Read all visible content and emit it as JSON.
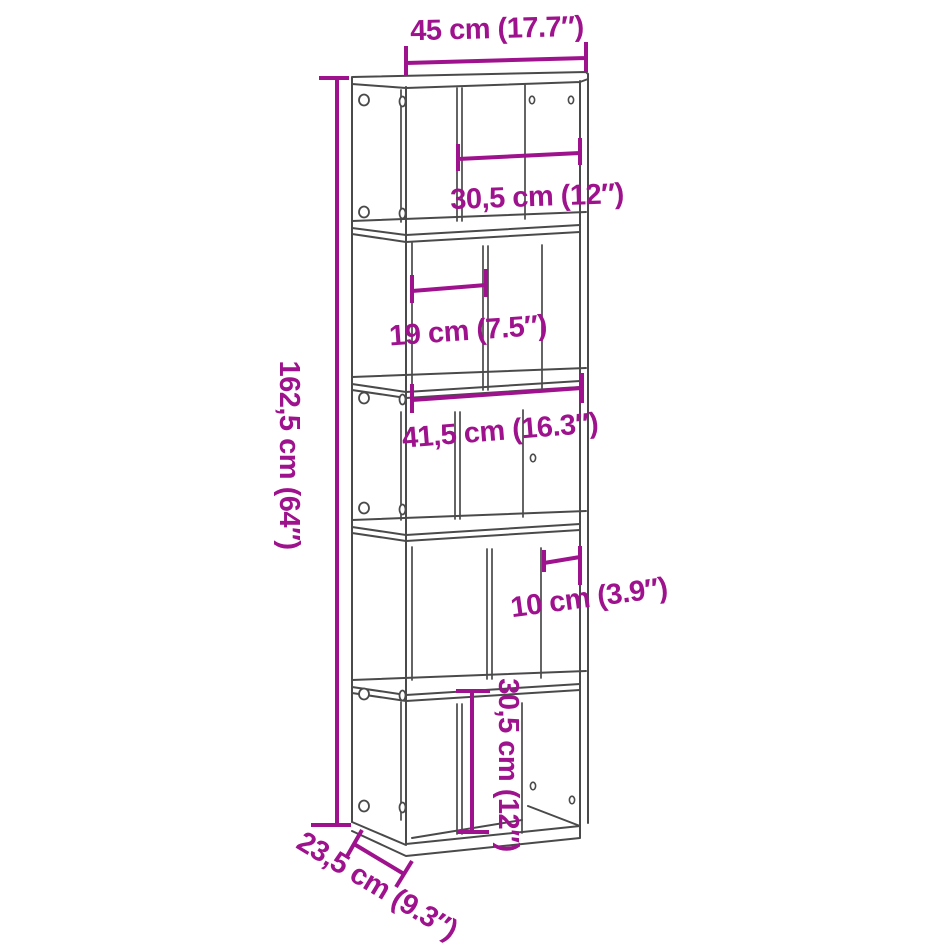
{
  "colors": {
    "accent": "#9E128D",
    "line": "#4A4A4A",
    "background": "#FFFFFF"
  },
  "diagram": {
    "type": "product-dimension-diagram",
    "product": "5-tier zigzag bookcase",
    "labels": {
      "overall_width": "45 cm (17.7″)",
      "tier1_width": "30,5 cm (12″)",
      "tier2_width": "19 cm (7.5″)",
      "tier3_width": "41,5 cm (16.3″)",
      "tier4_width": "10 cm (3.9″)",
      "overall_height": "162,5 cm (64″)",
      "tier5_height": "30,5 cm (12″)",
      "overall_depth": "23,5 cm (9.3″)"
    }
  }
}
